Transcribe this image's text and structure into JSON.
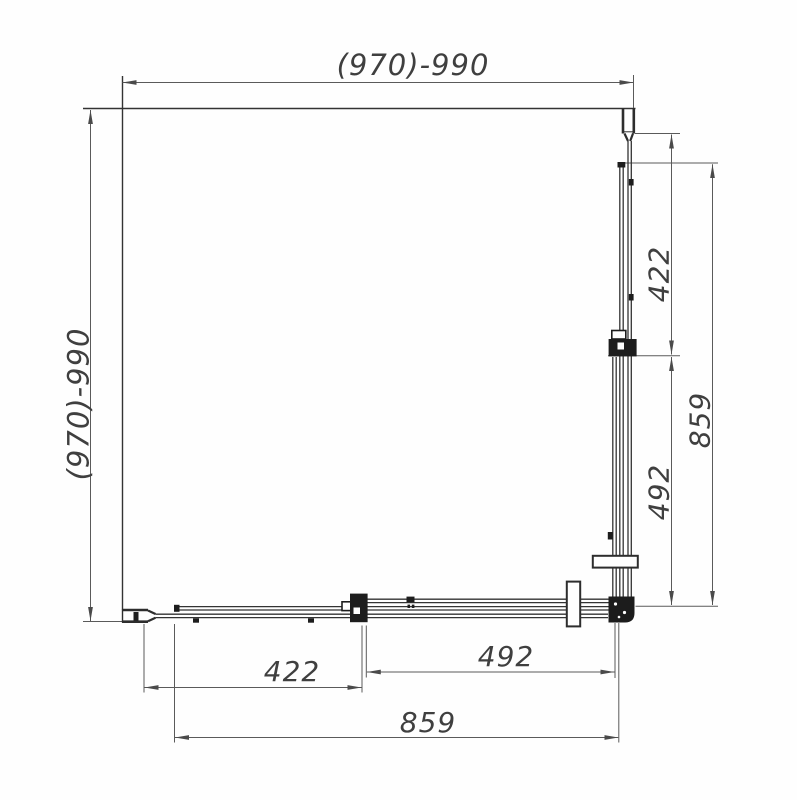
{
  "drawing": {
    "subject": "square sliding shower enclosure - top view technical drawing",
    "background": "#fefefe",
    "line_color": "#333333",
    "dim_line_color": "#5a5a5a",
    "fill_color": "#1d1d1d",
    "dims": {
      "top_width": "(970)-990",
      "left_depth": "(970)-990",
      "right_side": {
        "fixed_panel": "422",
        "door": "492",
        "total": "859"
      },
      "bottom_side": {
        "fixed_panel": "422",
        "door": "492",
        "total": "859"
      }
    }
  }
}
